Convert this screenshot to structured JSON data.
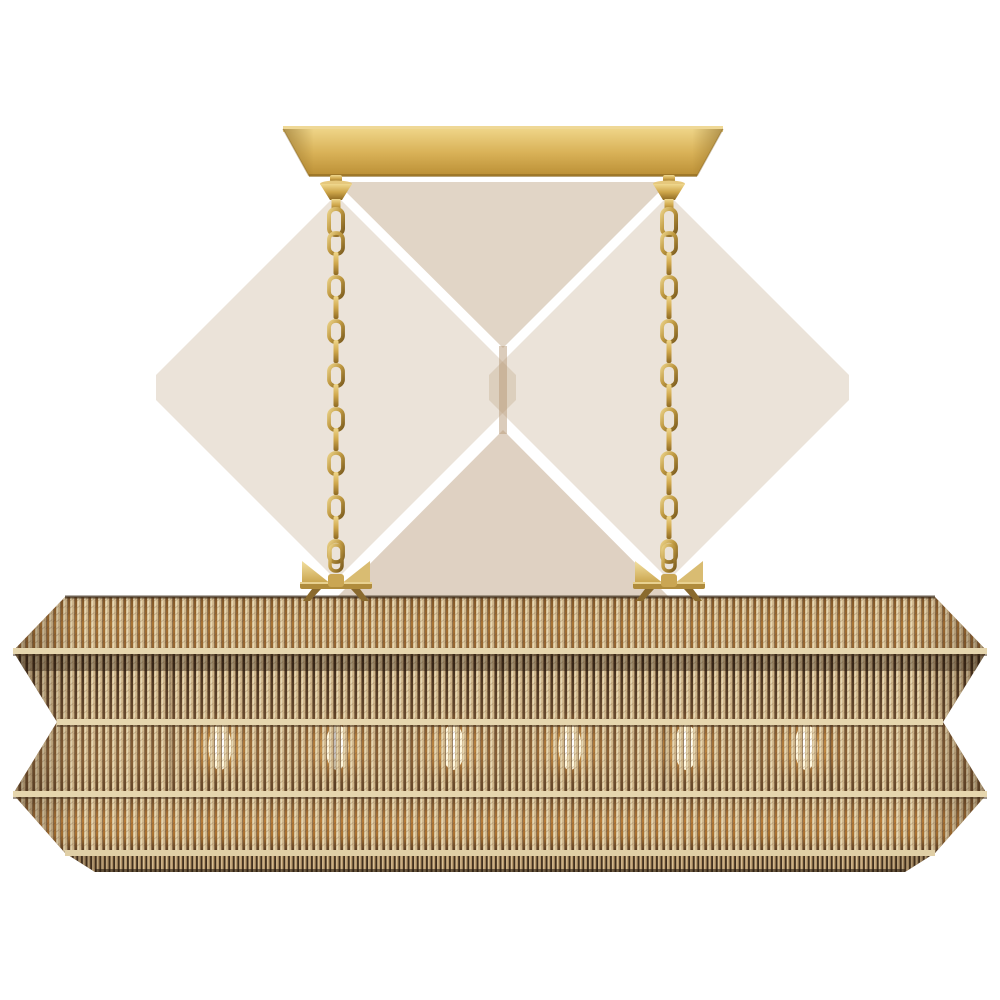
{
  "image": {
    "type": "product-photo",
    "alt": "Six-light linear chandelier with a four-tier flared woven natural rattan shade, hung by two brass chains from a rectangular brass ceiling canopy, shown lit on a white background",
    "background": "#ffffff"
  },
  "product": {
    "canopy": "rectangular antique brass ceiling canopy",
    "chains": {
      "count": 2,
      "style": "brass oval-link chain with turned brass finials"
    },
    "shade": {
      "material": "woven natural rattan rope",
      "tiers": 4,
      "shape": "flared linear pagoda with zig-zag profile"
    },
    "bulbs": {
      "count": 6,
      "state": "lit",
      "glow_y": 747,
      "glow_x": [
        220,
        337,
        453,
        570,
        686,
        806
      ]
    }
  },
  "colors": {
    "background": "#ffffff",
    "brass_light": "#ecd28c",
    "brass_mid": "#d2a84e",
    "brass_dark": "#9b7526",
    "brass_deep": "#6e5015",
    "rattan_rib": "#d0b68a",
    "rattan_highlight": "#e9dbb6",
    "rattan_shadow": "#8a6844",
    "gap_dark": "#5c442b",
    "gap_amber": "#b07a36",
    "glow_warm": "#ffdf9e",
    "bulb_core": "#fff7dd",
    "underside": "#41301e",
    "haze": "#b79a77"
  }
}
